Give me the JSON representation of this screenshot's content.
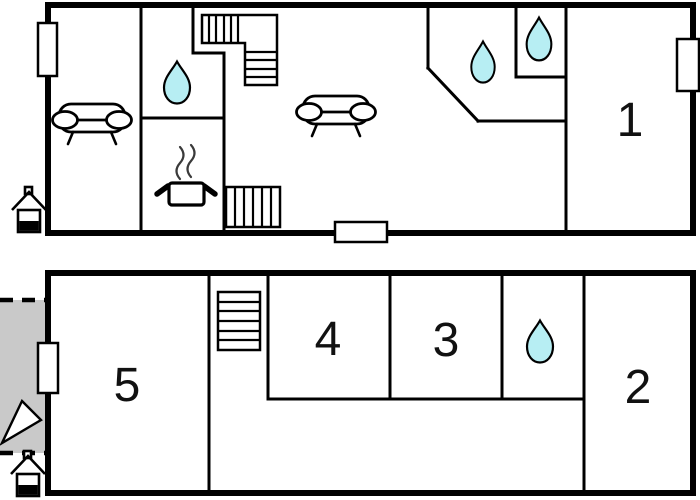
{
  "colors": {
    "background": "#ffffff",
    "wall": "#000000",
    "water_drop_fill": "#b7eef3",
    "terrace_fill": "#c9c9c9",
    "label": "#111111"
  },
  "upper_floor": {
    "room_labels": {
      "room1": "1"
    },
    "fixtures": [
      "sofa-icon",
      "sofa-icon",
      "stove-icon",
      "water-drop-icon",
      "water-drop-icon",
      "water-drop-icon",
      "staircase-l-icon",
      "staircase-icon",
      "window-marker",
      "window-marker",
      "door-marker",
      "entrance-house-icon"
    ]
  },
  "lower_floor": {
    "room_labels": {
      "room5": "5",
      "room4": "4",
      "room3": "3",
      "room2": "2"
    },
    "fixtures": [
      "staircase-icon",
      "water-drop-icon",
      "terrace-area",
      "door-swing-icon",
      "window-marker",
      "entrance-house-icon"
    ]
  }
}
